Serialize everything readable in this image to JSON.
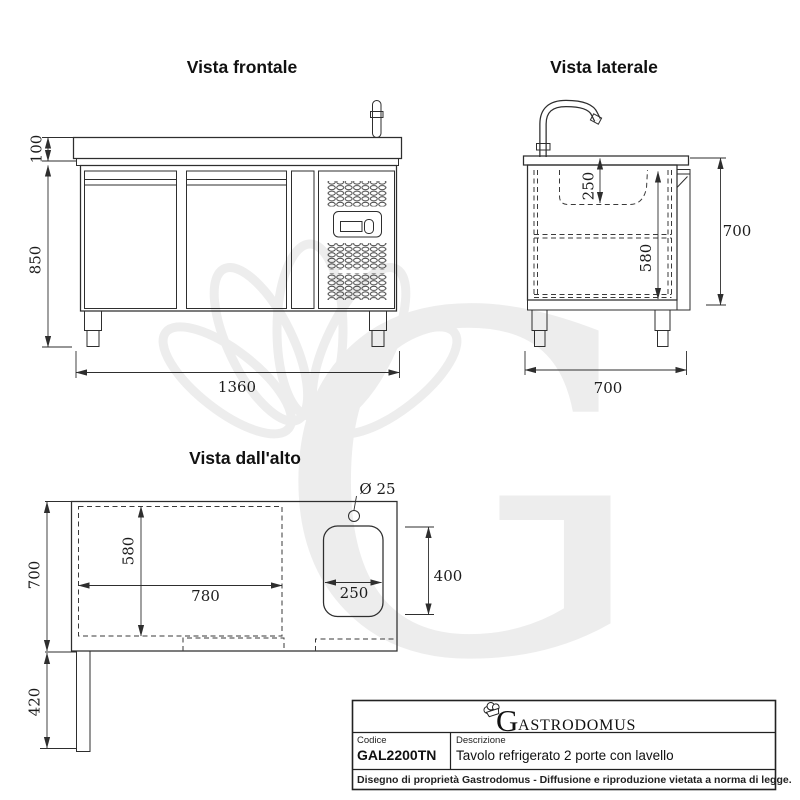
{
  "page": {
    "background": "#ffffff"
  },
  "views": {
    "front": {
      "title": "Vista frontale",
      "dim_top_height": "100",
      "dim_total_height": "850",
      "dim_width": "1360"
    },
    "side": {
      "title": "Vista laterale",
      "dim_sink_depth": "250",
      "dim_interior_height": "580",
      "dim_height": "700",
      "dim_depth": "700"
    },
    "top": {
      "title": "Vista dall'alto",
      "dim_hole": "Ø 25",
      "dim_interior_depth": "580",
      "dim_interior_width": "780",
      "dim_sink_width": "250",
      "dim_sink_length": "400",
      "dim_depth": "700",
      "dim_drain": "420"
    }
  },
  "title_block": {
    "brand_initial": "G",
    "brand_rest": "ASTRODOMUS",
    "code_label": "Codice",
    "code_value": "GAL2200TN",
    "description_label": "Descrizione",
    "description_value": "Tavolo refrigerato 2 porte con lavello",
    "legal_notice": "Disegno di proprietà Gastrodomus - Diffusione e riproduzione vietata a norma di legge."
  },
  "watermark": {
    "letter": "G"
  },
  "colors": {
    "line": "#2e2e2e",
    "dim_text": "#1c1c1c",
    "title_text": "#111111",
    "watermark": "#ededed"
  }
}
